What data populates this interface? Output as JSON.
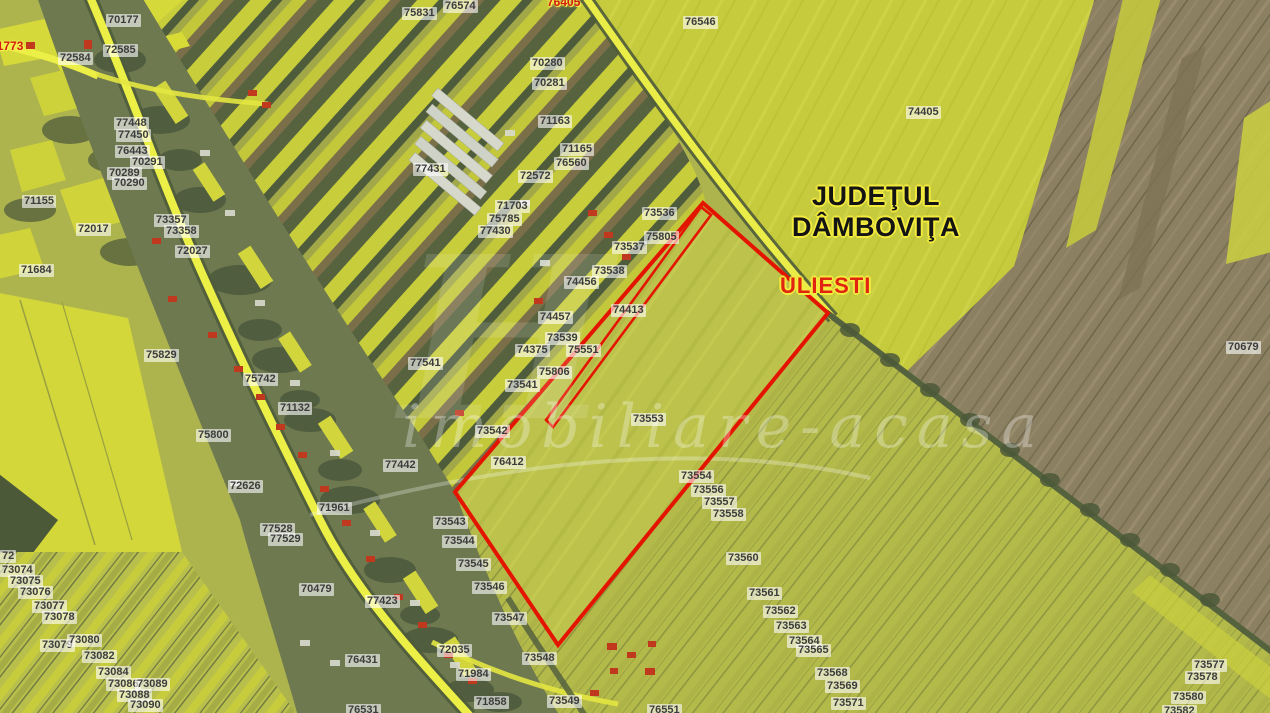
{
  "map": {
    "county_label": {
      "line1": "JUDEŢUL",
      "line2": "DÂMBOVIŢA"
    },
    "locality_label": "ULIESTI",
    "watermark": "imobiliare-acasa",
    "watermark_initial": "H",
    "colors": {
      "boundary_red": "#e41500",
      "label_text": "#3c3c3c",
      "red_label_text": "#d41f0e",
      "label_background": "rgba(255,255,255,0.60)",
      "county_text": "#141414",
      "outline_yellow": "#f2ea3c"
    },
    "parcel_labels": [
      {
        "text": "70177",
        "x": 106,
        "y": 14
      },
      {
        "text": "71773",
        "x": -12,
        "y": 40,
        "variant": "red"
      },
      {
        "text": "72584",
        "x": 58,
        "y": 52
      },
      {
        "text": "72585",
        "x": 103,
        "y": 44
      },
      {
        "text": "75831",
        "x": 402,
        "y": 7
      },
      {
        "text": "76574",
        "x": 443,
        "y": 0
      },
      {
        "text": "76405",
        "x": 545,
        "y": -4,
        "variant": "red"
      },
      {
        "text": "76546",
        "x": 683,
        "y": 16
      },
      {
        "text": "74405",
        "x": 906,
        "y": 106
      },
      {
        "text": "70280",
        "x": 530,
        "y": 57
      },
      {
        "text": "70281",
        "x": 532,
        "y": 77
      },
      {
        "text": "71163",
        "x": 538,
        "y": 115
      },
      {
        "text": "71165",
        "x": 560,
        "y": 143
      },
      {
        "text": "76560",
        "x": 554,
        "y": 157
      },
      {
        "text": "77431",
        "x": 413,
        "y": 163
      },
      {
        "text": "72572",
        "x": 518,
        "y": 170
      },
      {
        "text": "71703",
        "x": 495,
        "y": 200
      },
      {
        "text": "75785",
        "x": 487,
        "y": 213
      },
      {
        "text": "77430",
        "x": 478,
        "y": 225
      },
      {
        "text": "77448",
        "x": 114,
        "y": 117
      },
      {
        "text": "77450",
        "x": 116,
        "y": 129
      },
      {
        "text": "76443",
        "x": 115,
        "y": 145
      },
      {
        "text": "70291",
        "x": 130,
        "y": 156
      },
      {
        "text": "70289",
        "x": 107,
        "y": 167
      },
      {
        "text": "70290",
        "x": 112,
        "y": 177
      },
      {
        "text": "71155",
        "x": 22,
        "y": 195
      },
      {
        "text": "73357",
        "x": 154,
        "y": 214
      },
      {
        "text": "73358",
        "x": 164,
        "y": 225
      },
      {
        "text": "72017",
        "x": 76,
        "y": 223
      },
      {
        "text": "72027",
        "x": 175,
        "y": 245
      },
      {
        "text": "71684",
        "x": 19,
        "y": 264
      },
      {
        "text": "73536",
        "x": 642,
        "y": 207
      },
      {
        "text": "75805",
        "x": 644,
        "y": 231
      },
      {
        "text": "73537",
        "x": 612,
        "y": 241
      },
      {
        "text": "73538",
        "x": 592,
        "y": 265
      },
      {
        "text": "74456",
        "x": 564,
        "y": 276
      },
      {
        "text": "74457",
        "x": 538,
        "y": 311
      },
      {
        "text": "74413",
        "x": 611,
        "y": 304
      },
      {
        "text": "73539",
        "x": 545,
        "y": 332
      },
      {
        "text": "74375",
        "x": 515,
        "y": 344
      },
      {
        "text": "75551",
        "x": 566,
        "y": 344
      },
      {
        "text": "75806",
        "x": 537,
        "y": 366
      },
      {
        "text": "73541",
        "x": 505,
        "y": 379
      },
      {
        "text": "77541",
        "x": 408,
        "y": 357
      },
      {
        "text": "75829",
        "x": 144,
        "y": 349
      },
      {
        "text": "75742",
        "x": 243,
        "y": 373
      },
      {
        "text": "71132",
        "x": 278,
        "y": 402
      },
      {
        "text": "75800",
        "x": 196,
        "y": 429
      },
      {
        "text": "77442",
        "x": 383,
        "y": 459
      },
      {
        "text": "72626",
        "x": 228,
        "y": 480
      },
      {
        "text": "71961",
        "x": 317,
        "y": 502
      },
      {
        "text": "77528",
        "x": 260,
        "y": 523
      },
      {
        "text": "77529",
        "x": 268,
        "y": 533
      },
      {
        "text": "73542",
        "x": 475,
        "y": 425
      },
      {
        "text": "73553",
        "x": 631,
        "y": 413
      },
      {
        "text": "76412",
        "x": 491,
        "y": 456
      },
      {
        "text": "73543",
        "x": 433,
        "y": 516
      },
      {
        "text": "73544",
        "x": 442,
        "y": 535
      },
      {
        "text": "73545",
        "x": 456,
        "y": 558
      },
      {
        "text": "73546",
        "x": 472,
        "y": 581
      },
      {
        "text": "73547",
        "x": 492,
        "y": 612
      },
      {
        "text": "70479",
        "x": 299,
        "y": 583
      },
      {
        "text": "77423",
        "x": 365,
        "y": 595
      },
      {
        "text": "72035",
        "x": 437,
        "y": 644
      },
      {
        "text": "76431",
        "x": 345,
        "y": 654
      },
      {
        "text": "71984",
        "x": 456,
        "y": 668
      },
      {
        "text": "71858",
        "x": 474,
        "y": 696
      },
      {
        "text": "76531",
        "x": 346,
        "y": 704
      },
      {
        "text": "73548",
        "x": 522,
        "y": 652
      },
      {
        "text": "73549",
        "x": 547,
        "y": 695
      },
      {
        "text": "76551",
        "x": 647,
        "y": 704
      },
      {
        "text": "73554",
        "x": 679,
        "y": 470
      },
      {
        "text": "73556",
        "x": 691,
        "y": 484
      },
      {
        "text": "73557",
        "x": 702,
        "y": 496
      },
      {
        "text": "73558",
        "x": 711,
        "y": 508
      },
      {
        "text": "73560",
        "x": 726,
        "y": 552
      },
      {
        "text": "73561",
        "x": 747,
        "y": 587
      },
      {
        "text": "73562",
        "x": 763,
        "y": 605
      },
      {
        "text": "73563",
        "x": 774,
        "y": 620
      },
      {
        "text": "73564",
        "x": 787,
        "y": 635
      },
      {
        "text": "73565",
        "x": 796,
        "y": 644
      },
      {
        "text": "73568",
        "x": 815,
        "y": 667
      },
      {
        "text": "73569",
        "x": 825,
        "y": 680
      },
      {
        "text": "73571",
        "x": 831,
        "y": 697
      },
      {
        "text": "73577",
        "x": 1192,
        "y": 659
      },
      {
        "text": "73578",
        "x": 1185,
        "y": 671
      },
      {
        "text": "73580",
        "x": 1171,
        "y": 691
      },
      {
        "text": "73582",
        "x": 1162,
        "y": 705
      },
      {
        "text": "70679",
        "x": 1226,
        "y": 341
      },
      {
        "text": "72",
        "x": 0,
        "y": 550
      },
      {
        "text": "73074",
        "x": 0,
        "y": 564
      },
      {
        "text": "73075",
        "x": 8,
        "y": 575
      },
      {
        "text": "73076",
        "x": 18,
        "y": 586
      },
      {
        "text": "73077",
        "x": 32,
        "y": 600
      },
      {
        "text": "73078",
        "x": 42,
        "y": 611
      },
      {
        "text": "73079",
        "x": 40,
        "y": 639
      },
      {
        "text": "73080",
        "x": 67,
        "y": 634
      },
      {
        "text": "73082",
        "x": 82,
        "y": 650
      },
      {
        "text": "73084",
        "x": 96,
        "y": 666
      },
      {
        "text": "73086",
        "x": 106,
        "y": 678
      },
      {
        "text": "73089",
        "x": 135,
        "y": 678
      },
      {
        "text": "73088",
        "x": 117,
        "y": 689
      },
      {
        "text": "73090",
        "x": 128,
        "y": 699
      }
    ]
  }
}
